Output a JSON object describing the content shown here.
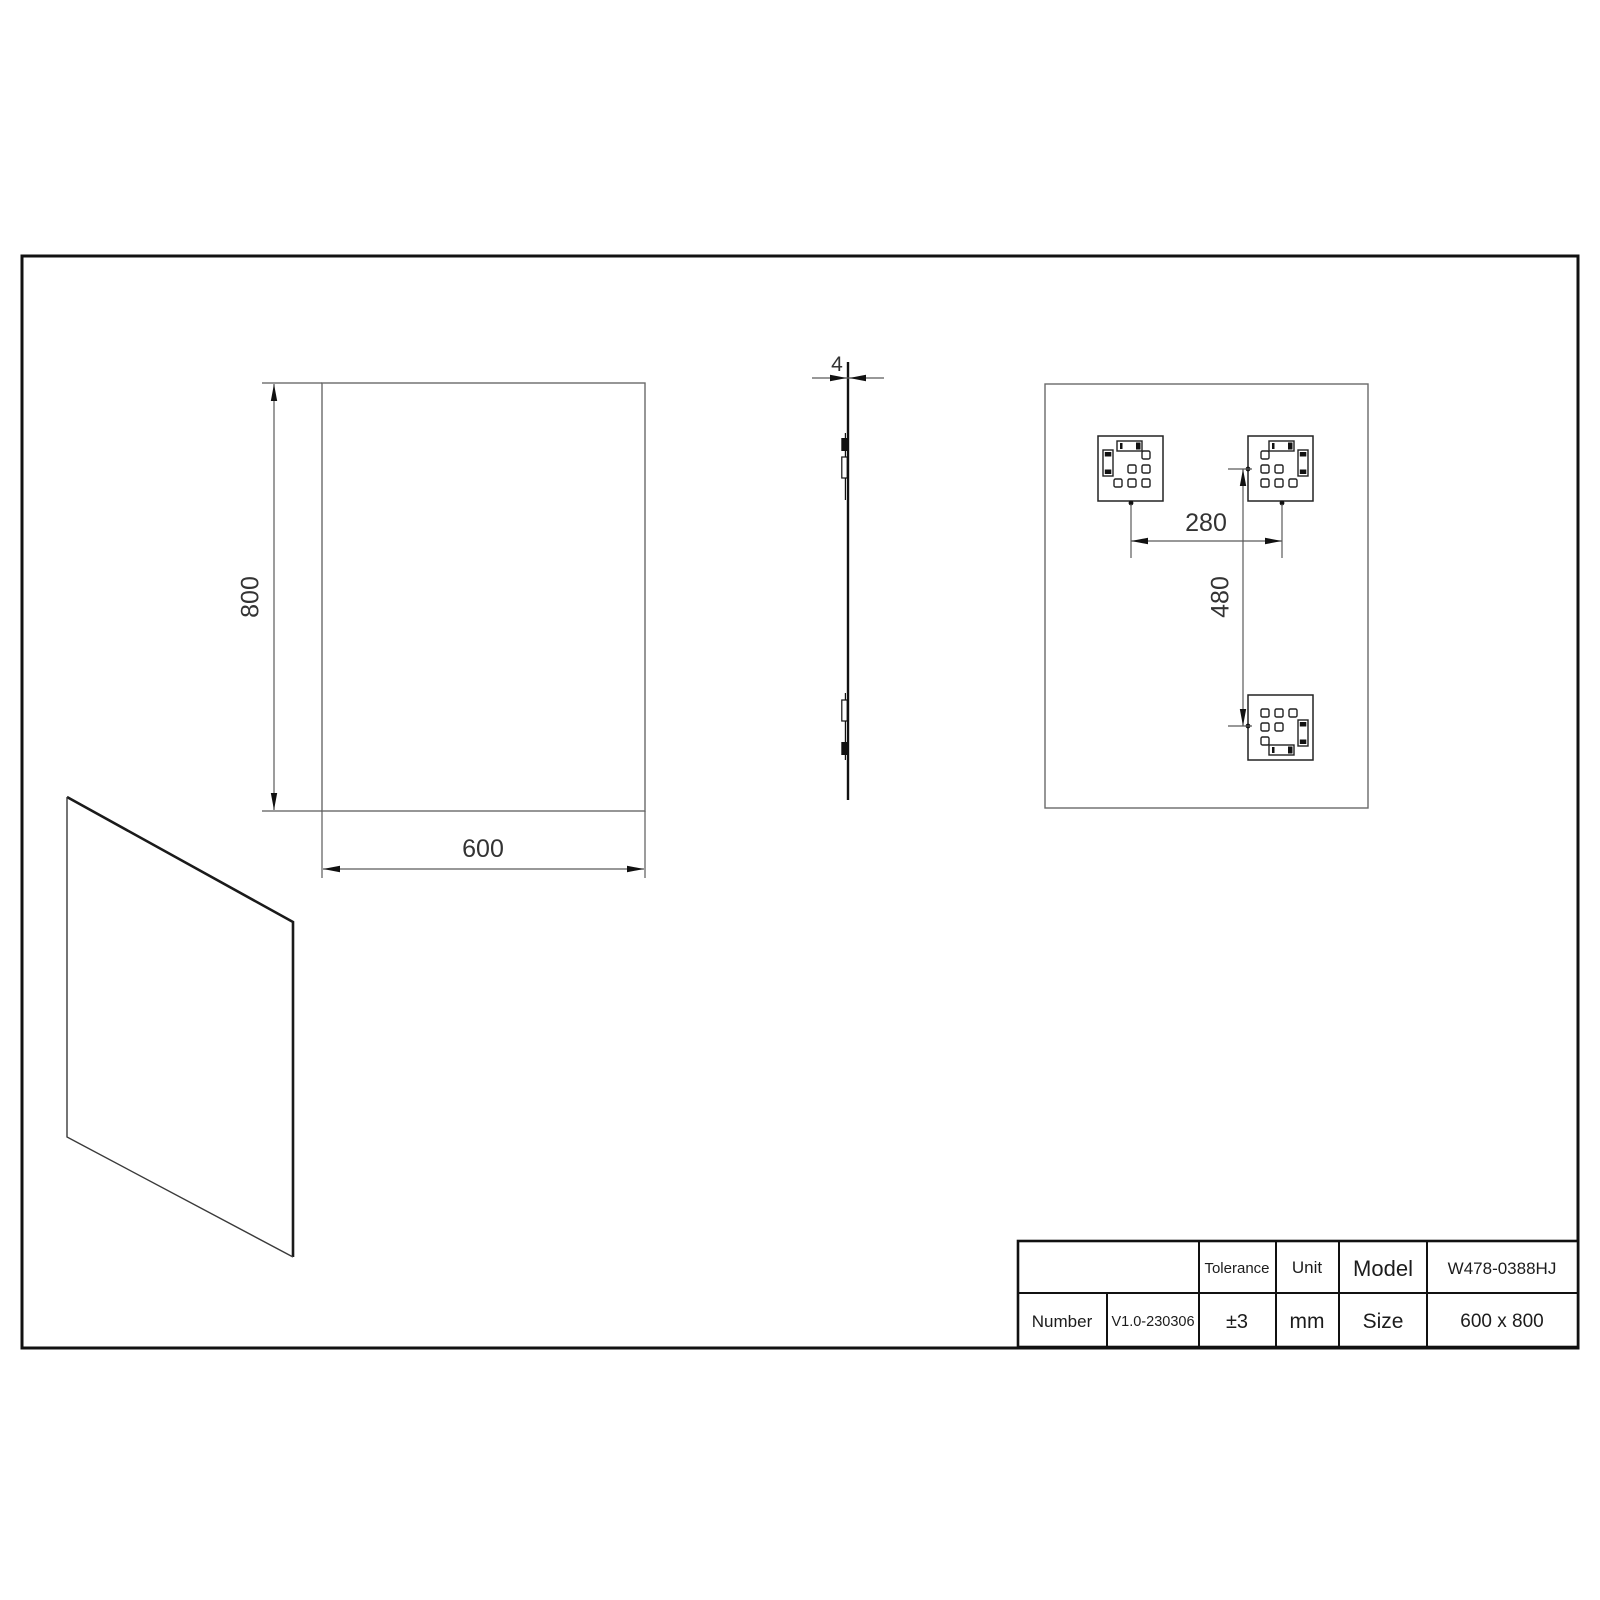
{
  "dimensions": {
    "front_height": "800",
    "front_width": "600",
    "thickness": "4",
    "bracket_spacing_horizontal": "280",
    "bracket_spacing_vertical": "480"
  },
  "title_block": {
    "number_label": "Number",
    "number_value": "V1.0-230306",
    "tolerance_label": "Tolerance",
    "tolerance_value": "±3",
    "unit_label": "Unit",
    "unit_value": "mm",
    "model_label": "Model",
    "model_value": "W478-0388HJ",
    "size_label": "Size",
    "size_value": "600 x 800"
  }
}
